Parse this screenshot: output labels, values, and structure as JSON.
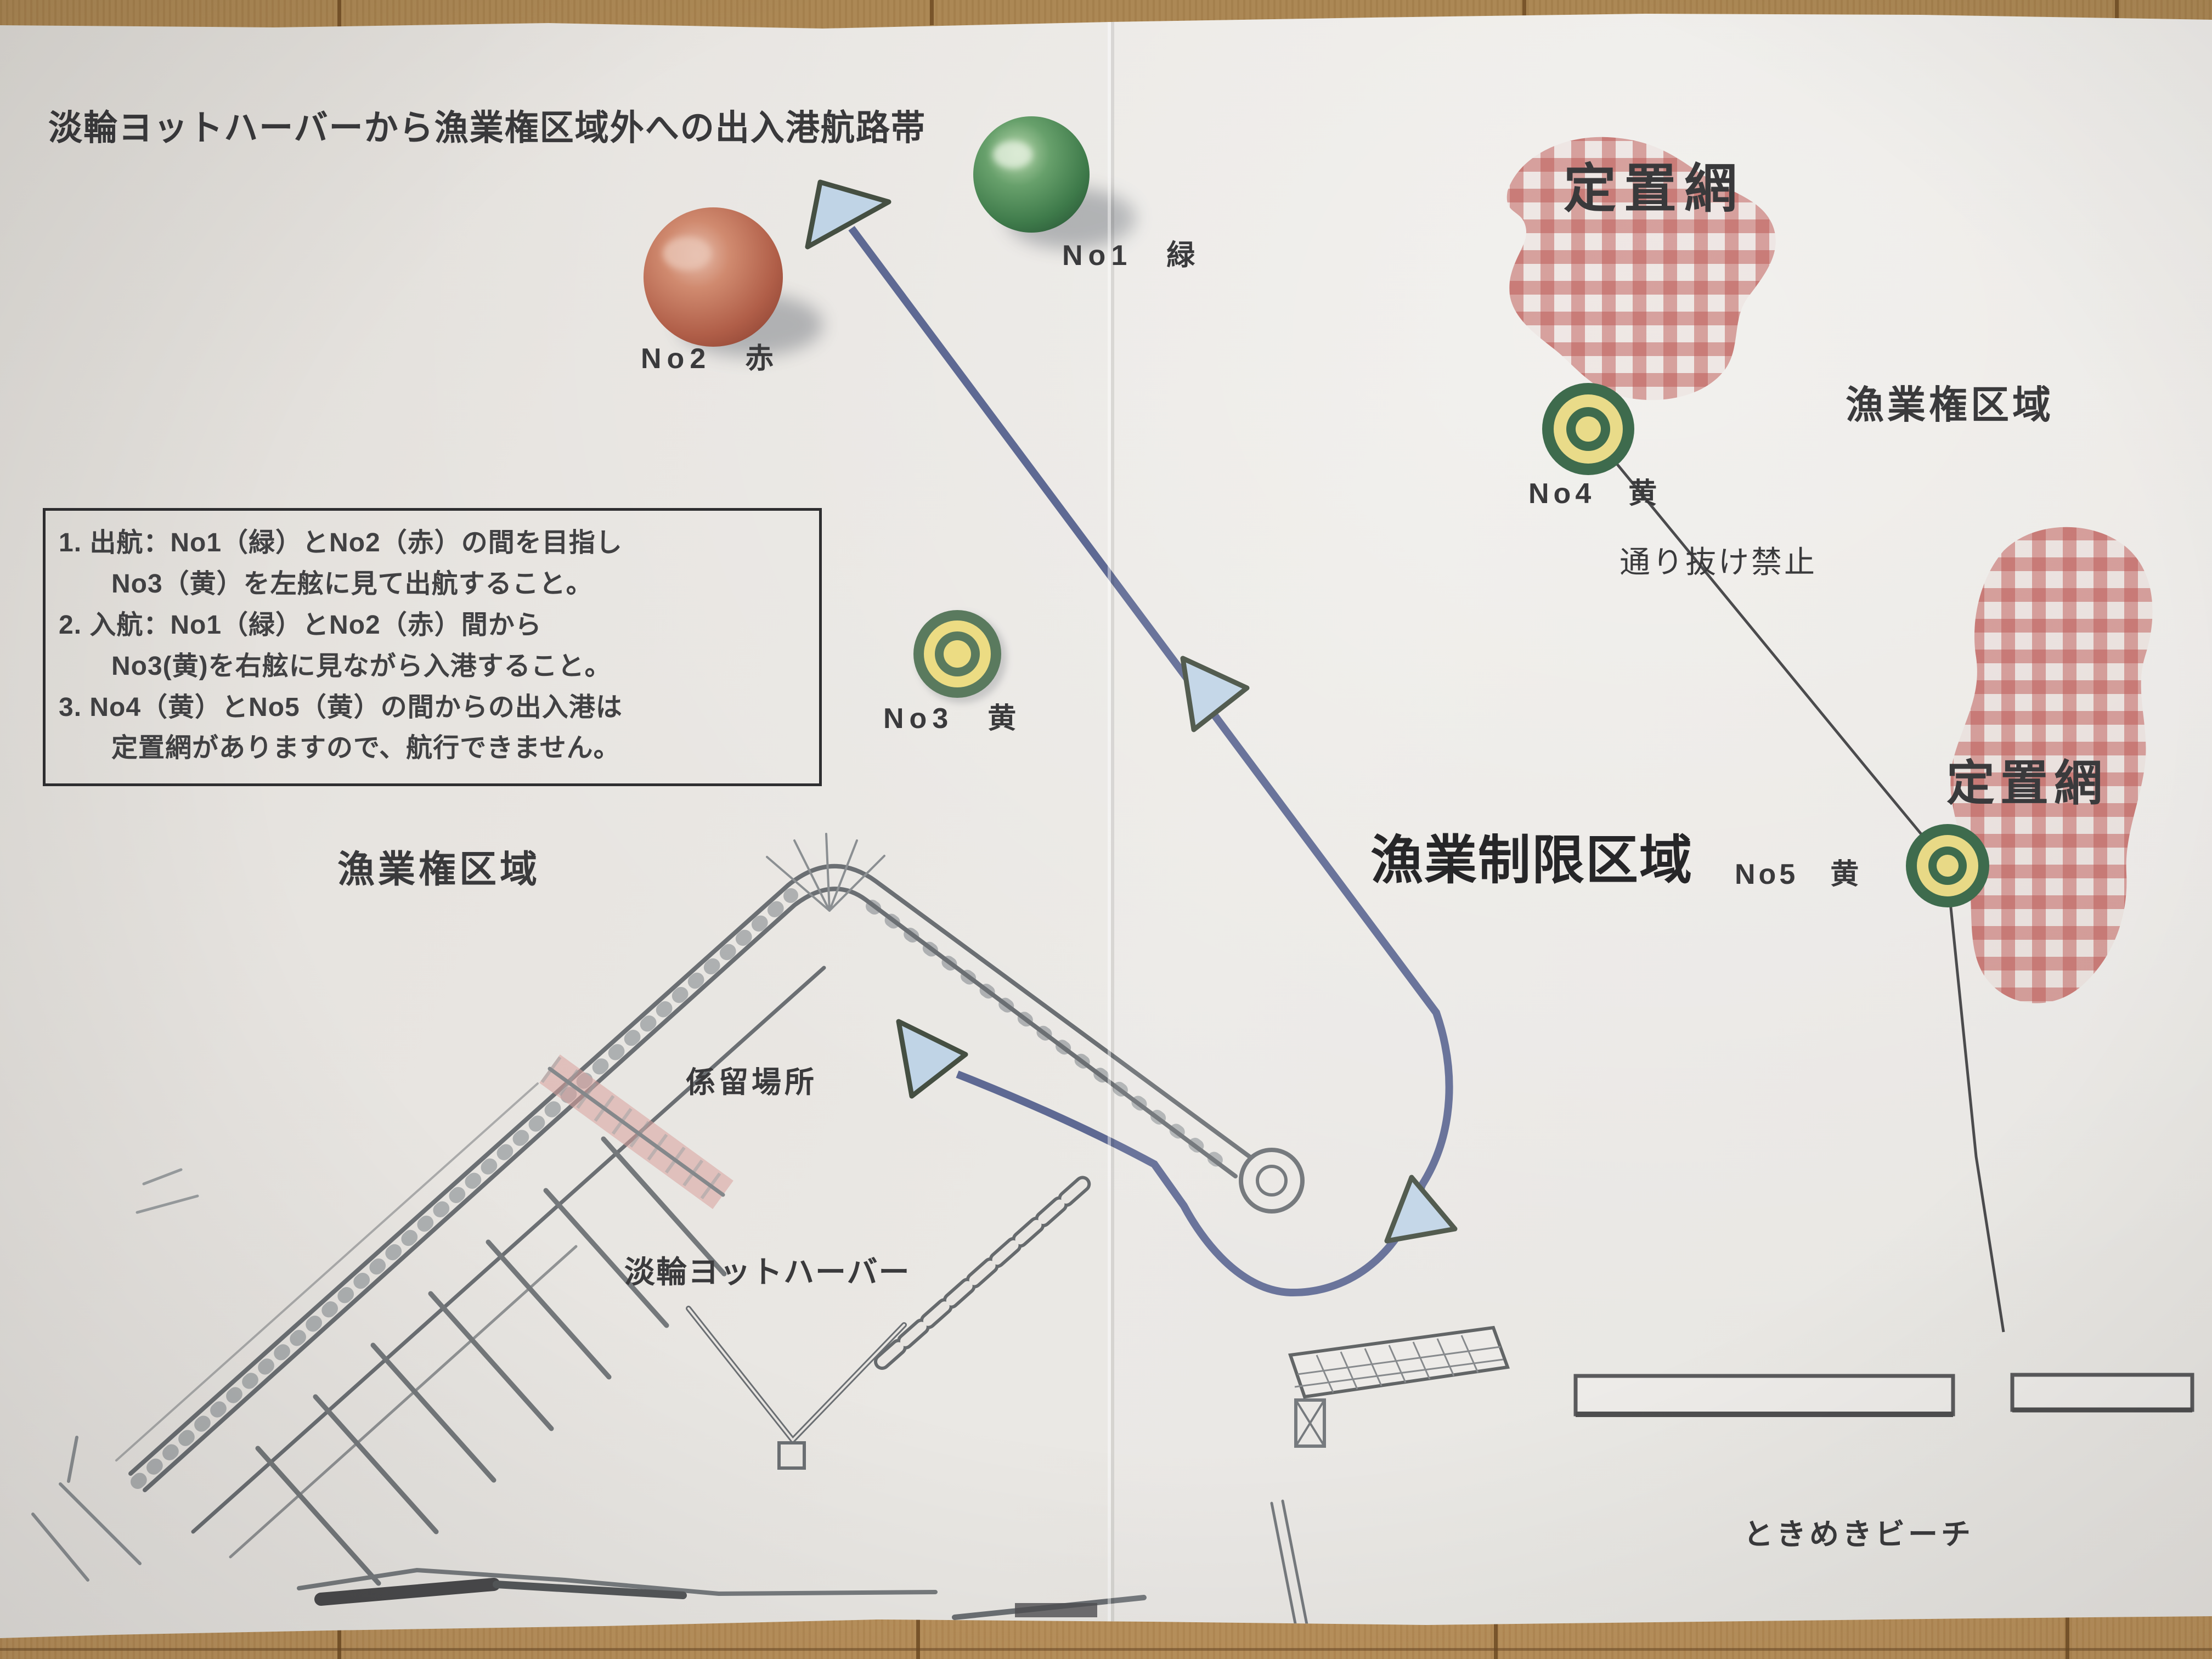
{
  "title": "淡輪ヨットハーバーから漁業権区域外への出入港航路帯",
  "instruction_box": {
    "lines": [
      "1. 出航：No1（緑）とNo2（赤）の間を目指し",
      "No3（黄）を左舷に見て出航すること。",
      "2. 入航：No1（緑）とNo2（赤）間から",
      "No3(黄)を右舷に見ながら入港すること。",
      "3. No4（黄）とNo5（黄）の間からの出入港は",
      "定置網がありますので、航行できません。"
    ]
  },
  "buoy_labels": {
    "no1": "No1　緑",
    "no2": "No2　赤",
    "no3": "No3　黄",
    "no4": "No4　黄",
    "no5": "No5　黄"
  },
  "area_labels": {
    "fixed_net_top": "定置網",
    "fixed_net_right": "定置網",
    "fishing_rights_right": "漁業権区域",
    "fishing_rights_left": "漁業権区域",
    "no_passage": "通り抜け禁止",
    "fishing_restricted": "漁業制限区域",
    "mooring_area": "係留場所",
    "yacht_harbor": "淡輪ヨットハーバー",
    "beach": "ときめきビーチ"
  },
  "colors": {
    "route_line": "#56628e",
    "arrow_fill": "#c0d4e6",
    "net_check_red": "#b23632",
    "buoy_green": "#3e7a4a",
    "buoy_red": "#b05e48",
    "buoy_yellow": "#ecdc83",
    "buoy_ring_green": "#2e5f3e",
    "paper": "#e8e5e1",
    "wood": "#b08a54"
  }
}
